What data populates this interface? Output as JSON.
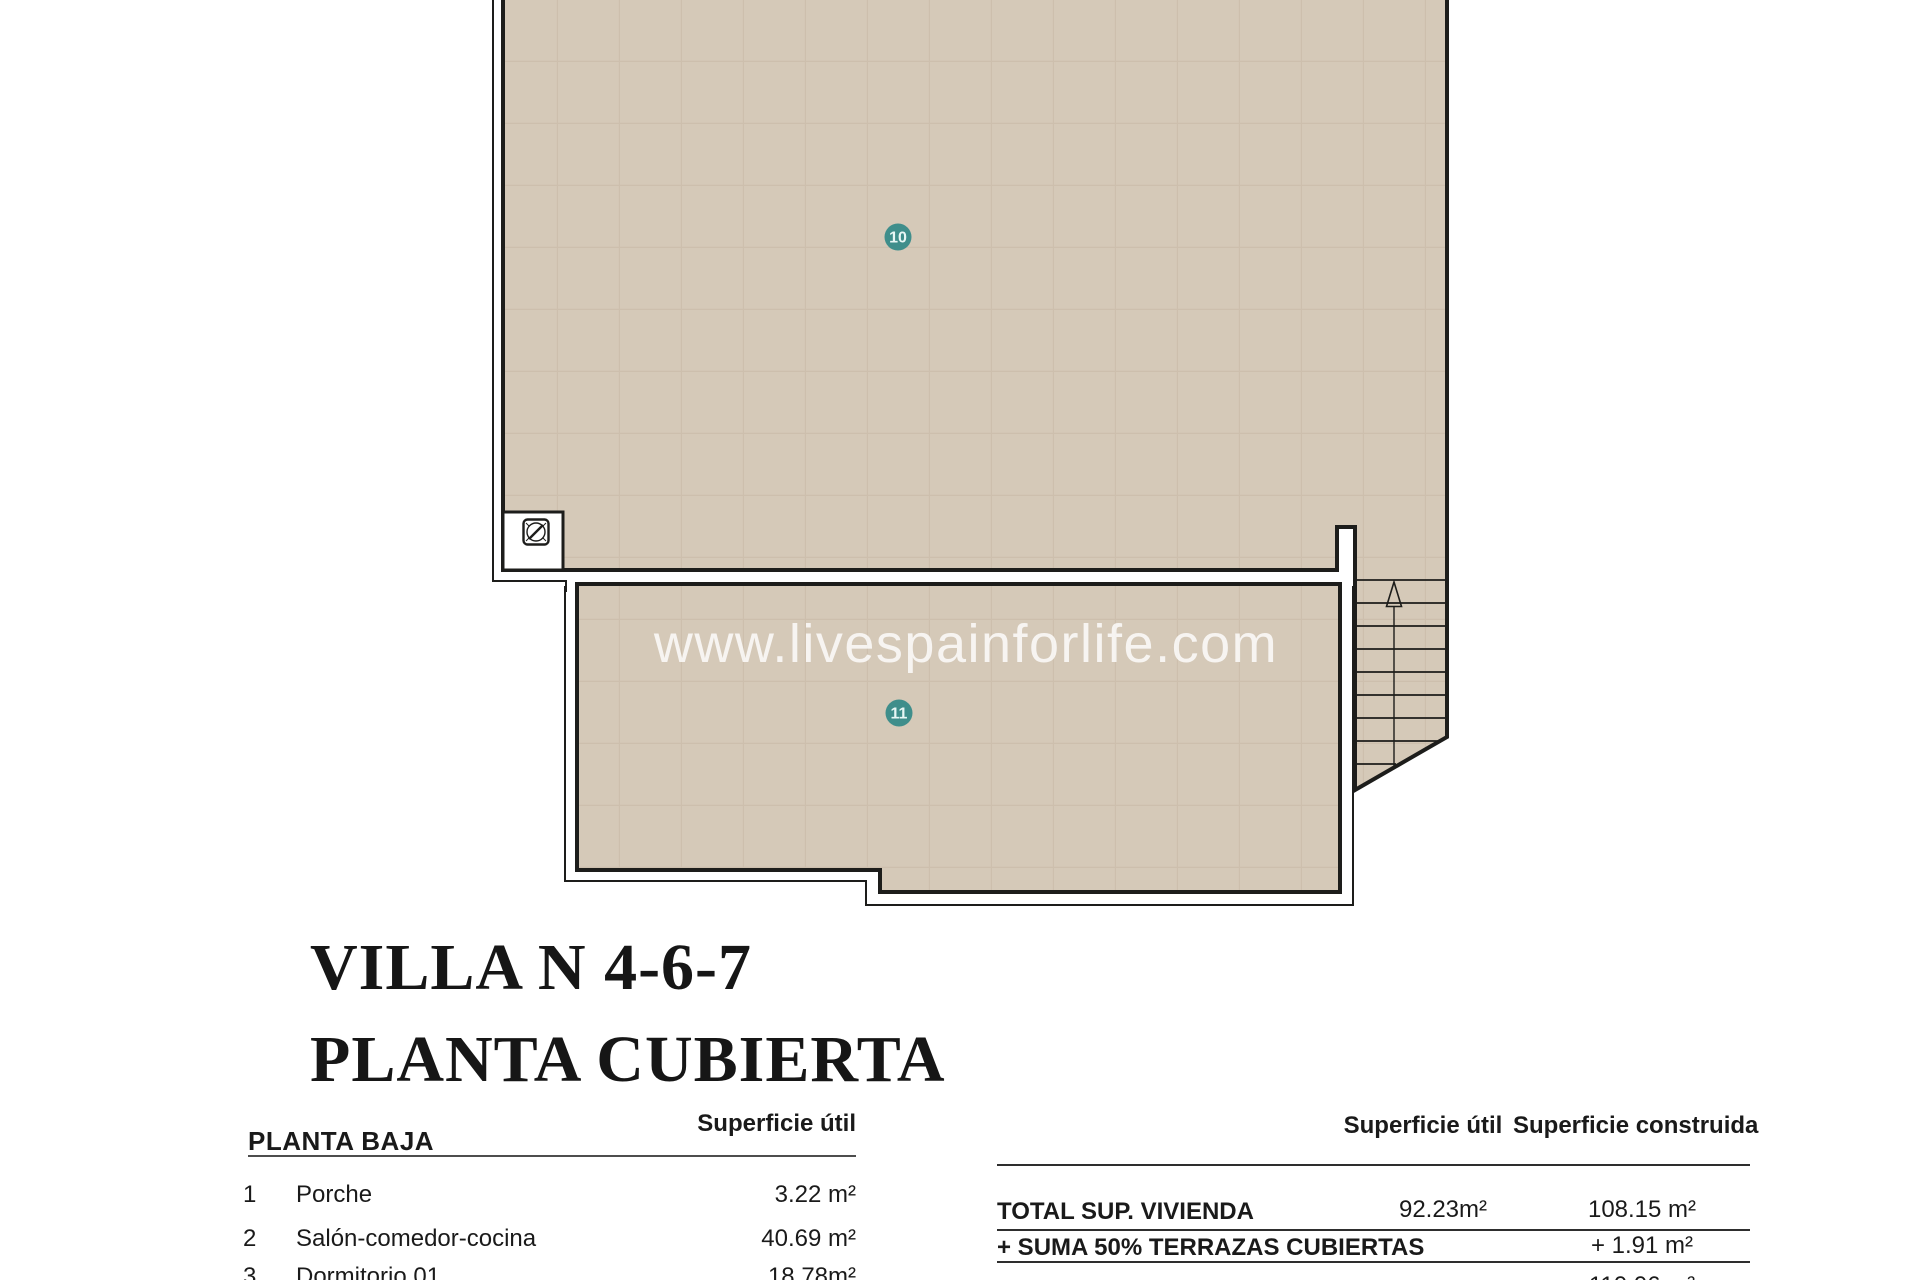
{
  "watermark": "www.livespainforlife.com",
  "title": {
    "line1": "VILLA N 4-6-7",
    "line2": "PLANTA CUBIERTA"
  },
  "plan": {
    "roof_fill": "#d5c9b8",
    "grid_line_color": "#c3b5a1",
    "wall_color": "#1d1d1b",
    "marker_color": "#3f8e8b",
    "marker_text_color": "#e8f7f5",
    "markers": [
      {
        "id": "10"
      },
      {
        "id": "11"
      }
    ]
  },
  "left_table": {
    "header": "PLANTA BAJA",
    "col_header": "Superficie útil",
    "rows": [
      {
        "num": "1",
        "name": "Porche",
        "value": "3.22 m²"
      },
      {
        "num": "2",
        "name": "Salón-comedor-cocina",
        "value": "40.69 m²"
      },
      {
        "num": "3",
        "name": "Dormitorio 01",
        "value": "18.78m²"
      }
    ]
  },
  "right_table": {
    "col1_header": "Superficie útil",
    "col2_header": "Superficie construida",
    "rows": [
      {
        "label": "TOTAL SUP. VIVIENDA",
        "util": "92.23m²",
        "construida": "108.15 m²"
      },
      {
        "label": "+ SUMA 50% TERRAZAS CUBIERTAS",
        "util": "",
        "construida": "+ 1.91 m²"
      },
      {
        "label": "",
        "util": "",
        "construida": "110.06 m²"
      }
    ]
  }
}
